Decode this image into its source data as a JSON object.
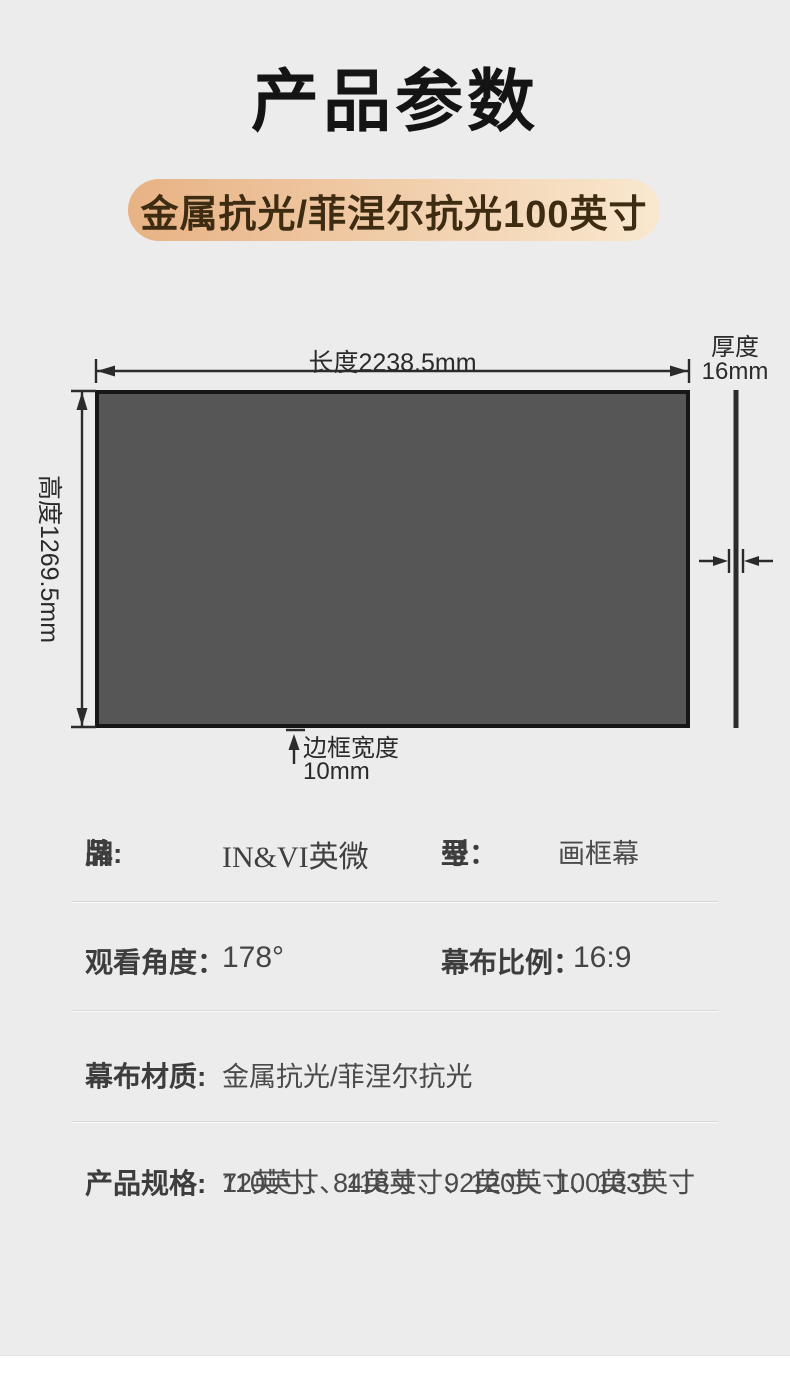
{
  "page": {
    "title": "产品参数",
    "bg_color": "#ececec"
  },
  "badge": {
    "text": "金属抗光/菲涅尔抗光100英寸",
    "gradient_start": "#e8b284",
    "gradient_end": "#f9e8cf",
    "text_color": "#3d2b12"
  },
  "diagram": {
    "length_label": "长度2238.5mm",
    "height_label": "高度1269.5mm",
    "thickness_line1": "厚度",
    "thickness_line2": "16mm",
    "border_line1": "边框宽度",
    "border_line2": "10mm",
    "screen_fill": "#565657",
    "screen_border": "#161616",
    "arrow_color": "#2b2b2b"
  },
  "specs": {
    "brand": {
      "label_c1": "品",
      "label_c2": "牌:",
      "value": "IN&VI英微"
    },
    "model": {
      "label_c1": "型",
      "label_c2": "号：",
      "value": "画框幕"
    },
    "view_angle": {
      "label": "观看角度：",
      "value": "178°"
    },
    "aspect_ratio": {
      "label": "幕布比例：",
      "value": "16:9"
    },
    "material": {
      "label": "幕布材质:",
      "value": "金属抗光/菲涅尔抗光"
    },
    "sizes": {
      "label": "产品规格:",
      "value_line1": "72英寸、84英寸、92英寸、100英寸",
      "value_line2": "110英寸、118英寸、120英寸、133英寸"
    }
  }
}
